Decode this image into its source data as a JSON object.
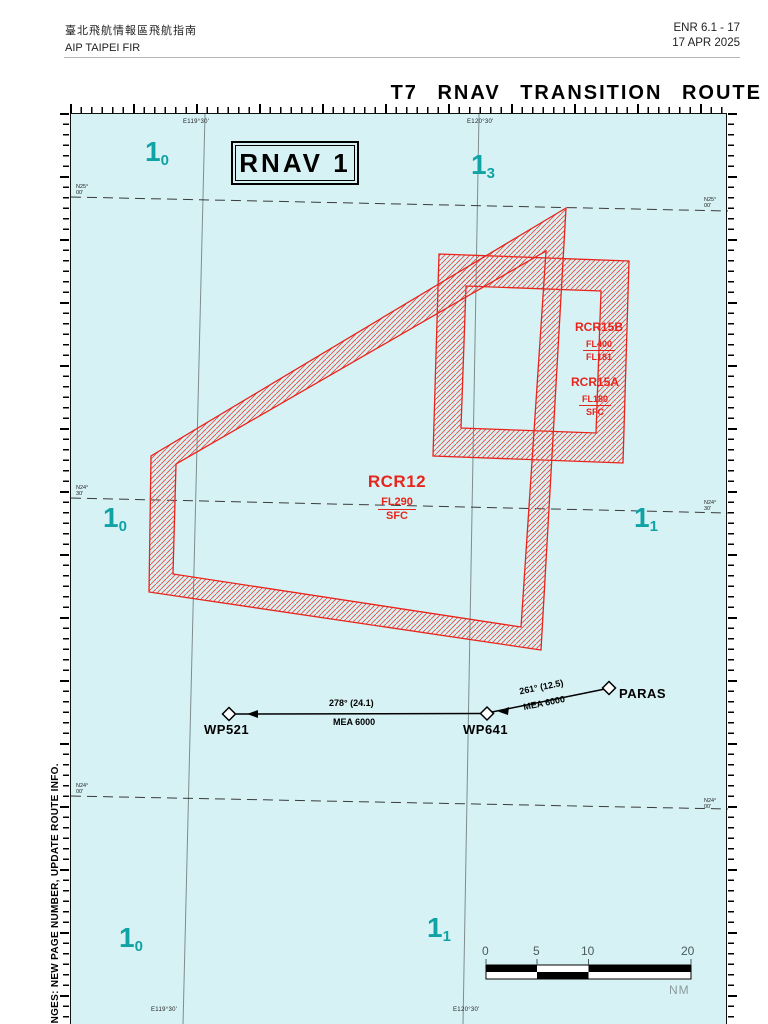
{
  "header": {
    "title_zh": "臺北飛航情報區飛航指南",
    "title_en": "AIP TAIPEI FIR",
    "doc_ref": "ENR 6.1 - 17",
    "date": "17 APR 2025"
  },
  "chart": {
    "title": "T7 RNAV TRANSITION ROUTE",
    "rnav_box_label": "RNAV 1",
    "side_note": "CHANGES: NEW PAGE NUMBER, UPDATE ROUTE INFO.",
    "colors": {
      "chart_bg": "#d7f2f5",
      "restricted_red": "#e8251c",
      "sector_teal": "#10a3a5"
    },
    "grid": {
      "meridian_labels": [
        "E119°30'",
        "E120°30'"
      ],
      "latitude_labels": [
        {
          "deg": "N25°",
          "min": "00'"
        },
        {
          "deg": "N24°",
          "min": "30'"
        },
        {
          "deg": "N24°",
          "min": "00'"
        }
      ],
      "sector_labels": [
        {
          "n": "1",
          "sub": "0"
        },
        {
          "n": "1",
          "sub": "3"
        },
        {
          "n": "1",
          "sub": "0"
        },
        {
          "n": "1",
          "sub": "1"
        },
        {
          "n": "1",
          "sub": "0"
        },
        {
          "n": "1",
          "sub": "1"
        }
      ]
    },
    "airspaces": [
      {
        "name": "RCR12",
        "upper": "FL290",
        "lower": "SFC"
      },
      {
        "name": "RCR15B",
        "upper": "FL400",
        "lower": "FL181"
      },
      {
        "name": "RCR15A",
        "upper": "FL180",
        "lower": "SFC"
      }
    ],
    "route": {
      "waypoints": [
        "WP521",
        "WP641",
        "PARAS"
      ],
      "legs": [
        {
          "bearing": "278° (24.1)",
          "mea": "MEA 6000"
        },
        {
          "bearing": "261° (12.5)",
          "mea": "MEA 6000"
        }
      ]
    },
    "scale_bar": {
      "ticks": [
        "0",
        "5",
        "10",
        "20"
      ],
      "unit": "NM"
    }
  }
}
